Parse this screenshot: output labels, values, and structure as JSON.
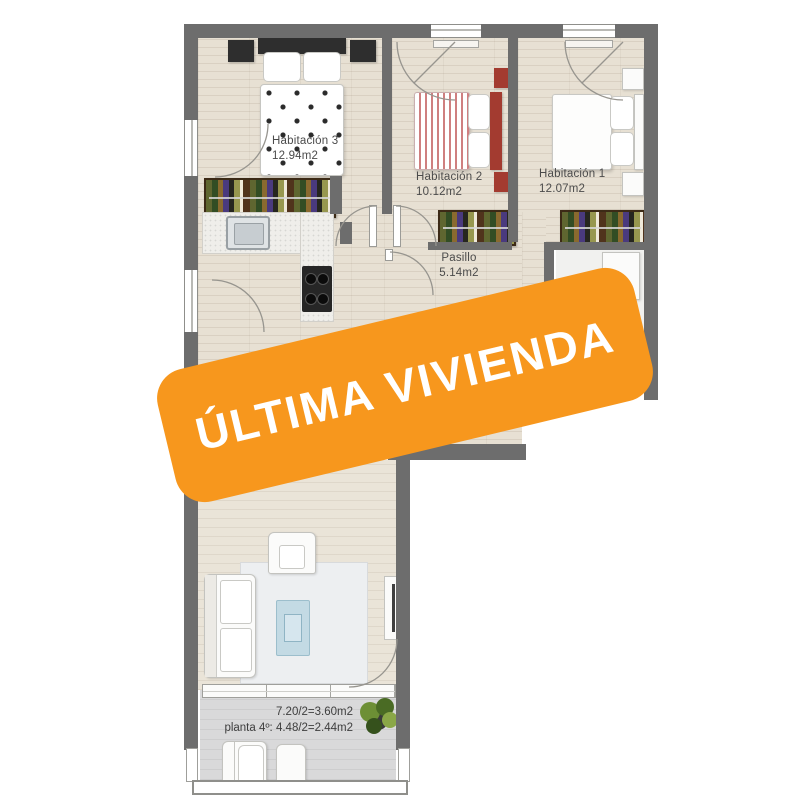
{
  "banner": {
    "label": "ÚLTIMA VIVIENDA",
    "background_color": "#f7971d",
    "text_color": "#ffffff"
  },
  "rooms": [
    {
      "name": "Habitación 3",
      "area": "12.94m2"
    },
    {
      "name": "Habitación 2",
      "area": "10.12m2"
    },
    {
      "name": "Habitación 1",
      "area": "12.07m2"
    },
    {
      "name": "Pasillo",
      "area": "5.14m2"
    }
  ],
  "terrace": {
    "line1": "7.20/2=3.60m2",
    "line2": "planta 4º: 4.48/2=2.44m2"
  },
  "colors": {
    "wall": "#6d6d6d",
    "wood_floor": "#e7e0d3",
    "terrace_floor": "#d9d9da",
    "bed_accent_red": "#a33b30",
    "banner_orange": "#f7971d"
  },
  "icons": {
    "plant_icon": "potted plant foliage cluster",
    "door_arc_icon": "quarter-circle door swing",
    "stove_icon": "4-burner cooktop"
  }
}
